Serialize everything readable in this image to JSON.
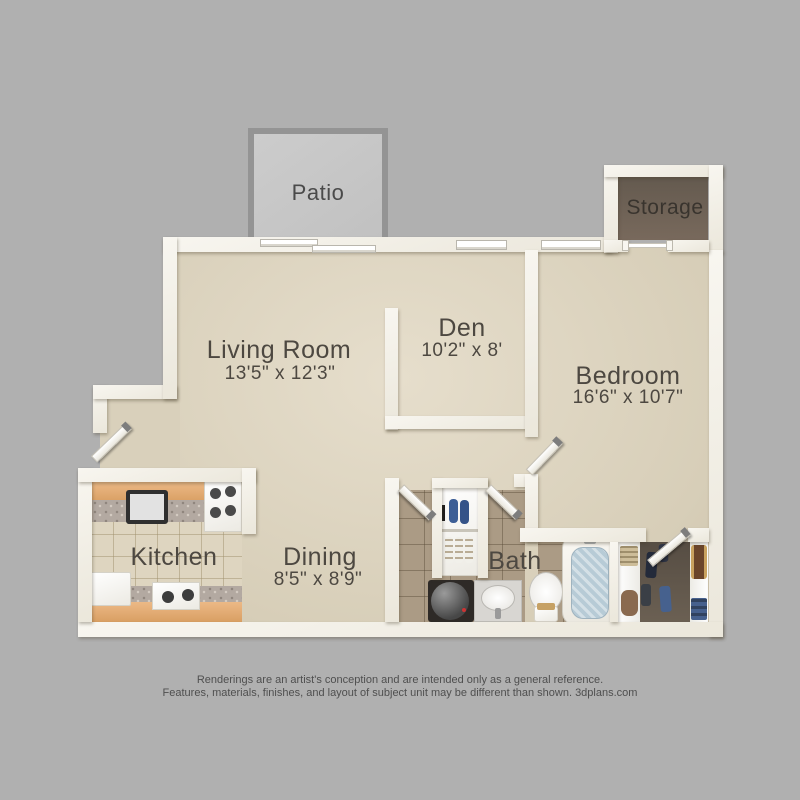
{
  "colors": {
    "page_bg": "#b0b0b0",
    "wall": "#f4f1ea",
    "floor": "#dcd3bf",
    "kitchen_tile": "#ded5c0",
    "bath_tile": "#ab9b85",
    "storage_floor": "#6e6459",
    "closet_floor": "#5f564b",
    "patio_floor": "#c6c6c6",
    "patio_frame": "#949494",
    "counter_wood": "#e2ab74",
    "granite": "#b3a9a1",
    "label_text": "#4d4841",
    "footer_text": "#4f4f4f"
  },
  "rooms": {
    "patio": {
      "label": "Patio"
    },
    "storage": {
      "label": "Storage"
    },
    "living": {
      "label": "Living Room",
      "dims": "13'5\" x 12'3\""
    },
    "den": {
      "label": "Den",
      "dims": "10'2\" x 8'"
    },
    "bedroom": {
      "label": "Bedroom",
      "dims": "16'6\" x 10'7\""
    },
    "kitchen": {
      "label": "Kitchen"
    },
    "dining": {
      "label": "Dining",
      "dims": "8'5\" x 8'9\""
    },
    "bath": {
      "label": "Bath"
    }
  },
  "footer": {
    "line1": "Renderings are an artist's conception and are intended only as a general reference.",
    "line2": "Features, materials, finishes, and layout of subject unit may be different than shown. 3dplans.com"
  }
}
